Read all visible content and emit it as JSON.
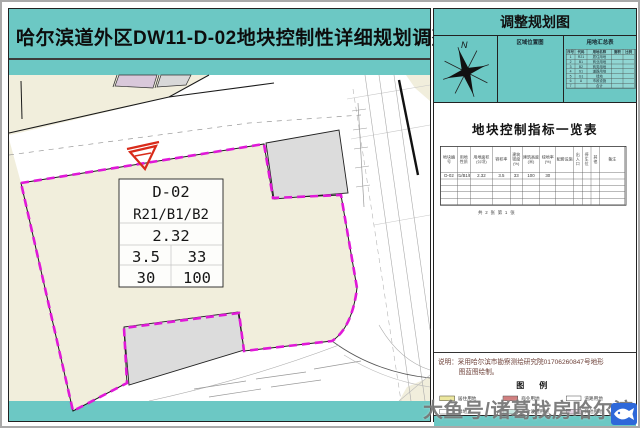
{
  "left_panel": {
    "title": "哈尔滨道外区DW11-D-02地块控制性详细规划调整"
  },
  "map": {
    "label_box": {
      "parcel_id": "D-02",
      "land_use": "R21/B1/B2",
      "far": "2.32",
      "row2_left": "3.5",
      "row2_right": "33",
      "row3_left": "30",
      "row3_right": "100"
    }
  },
  "right_panel": {
    "header": "调整规划图",
    "compass": "N",
    "location_cell_label": "区域位置图",
    "summary_cell_label": "用地汇总表",
    "summary_table": {
      "headers": [
        "序号",
        "代码",
        "用地名称",
        "面积",
        "比例"
      ],
      "rows": [
        [
          "1",
          "R21",
          "居住用地",
          "",
          ""
        ],
        [
          "2",
          "B1",
          "商业用地",
          "",
          ""
        ],
        [
          "3",
          "B2",
          "商务用地",
          "",
          ""
        ],
        [
          "4",
          "S1",
          "道路用地",
          "",
          ""
        ],
        [
          "5",
          "G1",
          "绿地",
          "",
          ""
        ],
        [
          "6",
          "U",
          "市政设施",
          "",
          ""
        ],
        [
          "7",
          "",
          "合计",
          "",
          ""
        ]
      ]
    },
    "indicator_table": {
      "title": "地块控制指标一览表",
      "headers": [
        "地块编号",
        "用地性质",
        "用地面积(公顷)",
        "容积率",
        "建筑密度(%)",
        "建筑高度(米)",
        "绿地率(%)",
        "配套设施",
        "出入口",
        "停车位",
        "其他",
        "备注"
      ],
      "row": [
        "D-02",
        "R21/B1/B2",
        "2.32",
        "3.5",
        "33",
        "100",
        "30",
        "",
        "",
        "",
        "",
        ""
      ],
      "sheet_note": "共 2 张  第 1 张"
    },
    "notes": {
      "line1": "说明：采用哈尔滨市勘察测绘研究院01706260847号地形",
      "line2": "图蓝图绘制。"
    },
    "legend": {
      "title": "图  例",
      "items": [
        {
          "label": "居住用地",
          "css": "#ece79f"
        },
        {
          "label": "商业用地",
          "css": "repeating-linear-gradient(0deg,#d88f8f 0px,#d88f8f 1px,#c96f6f 1px,#c96f6f 2px)"
        },
        {
          "label": "道路用地",
          "css": "#ffffff"
        },
        {
          "label": "绿地",
          "css": "#ffffff"
        },
        {
          "label": "市政设施用地",
          "css": "repeating-linear-gradient(0deg,#ffffff 0px,#ffffff 1px,#8fccbf 1px,#8fccbf 2.5px)"
        },
        {
          "label": "其他用地",
          "css": "#e6d2e4"
        }
      ]
    },
    "footer": "哈尔滨道外区DW11-D-02地块控制性详细规划调整"
  },
  "watermark": "大鱼号/诸葛找房哈尔滨",
  "colors": {
    "teal": "#6cc8c4",
    "magenta": "#e018d8",
    "cream": "#f1eedc",
    "building_gray": "#dcdcdc",
    "marker_red": "#d92b1a",
    "lavender": "#d9c8da",
    "watermark_gray": "#787878",
    "logo_blue": "#2e68d9"
  }
}
